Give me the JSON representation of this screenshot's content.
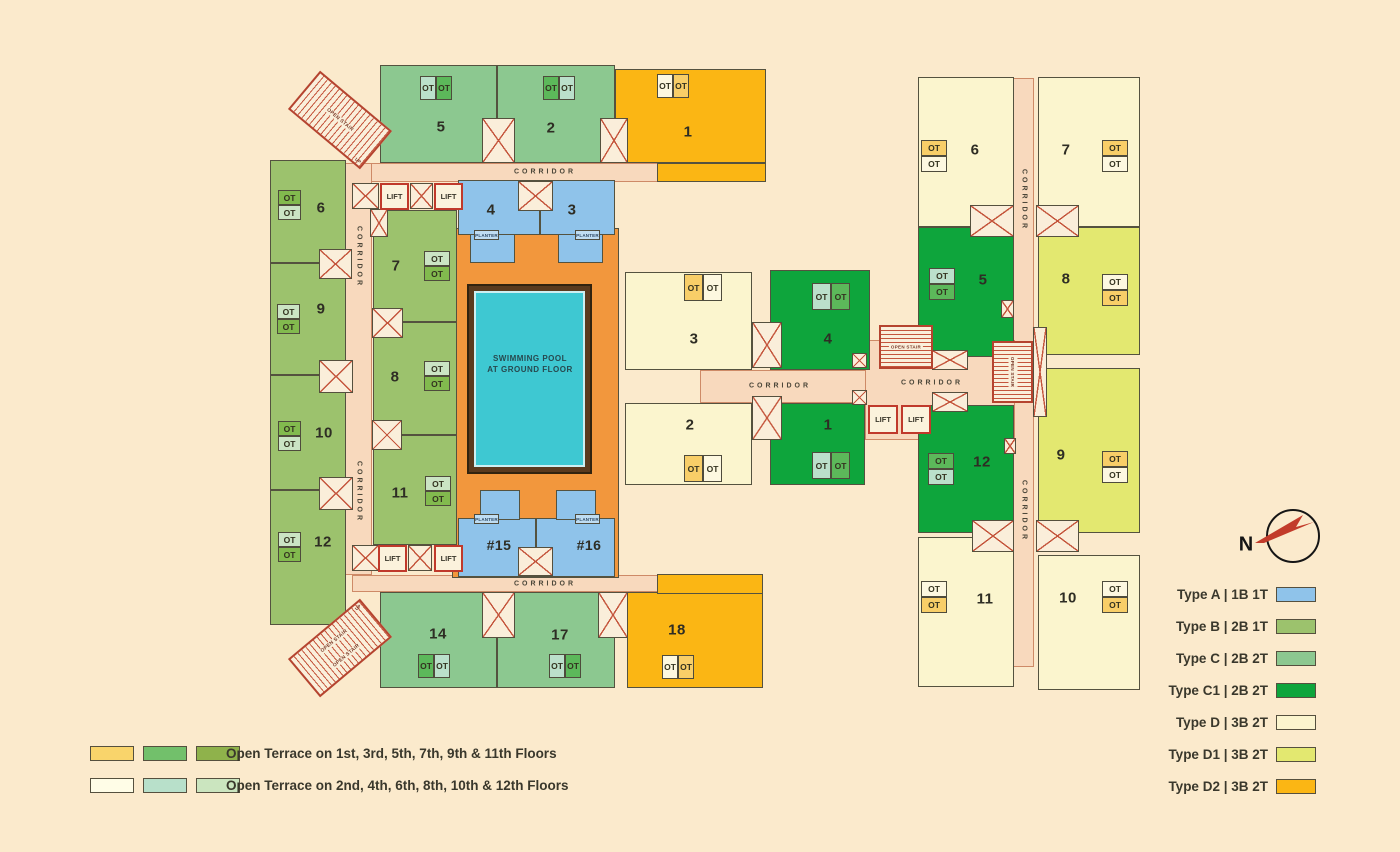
{
  "labels": {
    "corridor": "CORRIDOR",
    "lift": "LIFT",
    "open_stair": "OPEN STAIR",
    "planter": "PLANTER",
    "ot": "OT",
    "up": "UP",
    "north": "N"
  },
  "pool": {
    "line1": "SWIMMING POOL",
    "line2": "AT GROUND FLOOR"
  },
  "units": {
    "left": {
      "u1": "1",
      "u2": "2",
      "u3": "3",
      "u4": "4",
      "u5": "5",
      "u6": "6",
      "u7": "7",
      "u8": "8",
      "u9": "9",
      "u10": "10",
      "u11": "11",
      "u12": "12",
      "u14": "14",
      "u15": "#15",
      "u16": "#16",
      "u17": "17",
      "u18": "18"
    },
    "wing": {
      "w1": "1",
      "w2": "2",
      "w3": "3",
      "w4": "4"
    },
    "right": {
      "r5": "5",
      "r6": "6",
      "r7": "7",
      "r8": "8",
      "r9": "9",
      "r10": "10",
      "r11": "11",
      "r12": "12"
    }
  },
  "type_legend": [
    {
      "label": "Type A | 1B 1T",
      "color": "#8FC3EA"
    },
    {
      "label": "Type B | 2B 1T",
      "color": "#9CC26D"
    },
    {
      "label": "Type C | 2B 2T",
      "color": "#8CC890"
    },
    {
      "label": "Type C1 | 2B 2T",
      "color": "#0EA53C"
    },
    {
      "label": "Type D | 3B 2T",
      "color": "#FBF5CE"
    },
    {
      "label": "Type D1 | 3B 2T",
      "color": "#E3E870"
    },
    {
      "label": "Type D2 | 3B 2T",
      "color": "#FBB614"
    }
  ],
  "terrace_legend": [
    {
      "text": "Open Terrace on 1st, 3rd, 5th, 7th, 9th & 11th Floors",
      "swatches": [
        "#F9D46B",
        "#72C06B",
        "#8FB24B"
      ]
    },
    {
      "text": "Open Terrace on 2nd, 4th, 6th, 8th, 10th & 12th Floors",
      "swatches": [
        "#FFFDE7",
        "#B8E0CA",
        "#CBE5BF"
      ]
    }
  ],
  "colors": {
    "background": "#FBEACC",
    "corridor": "#F8D9BD",
    "pool_deck": "#F2973D",
    "pool_water": "#3EC8D2",
    "type_a_blue": "#8FC3EA",
    "type_c1_green": "#0EA53C",
    "ot_gold": "#F8CE68",
    "ot_cream": "#FDF8E0",
    "ot_green": "#5CB85A",
    "ot_teal": "#BBE0CB",
    "ot_olive": "#82BA4E",
    "ot_pale": "#CBE4C4",
    "stair_red": "#B5442F",
    "compass_red": "#C23B2A"
  }
}
